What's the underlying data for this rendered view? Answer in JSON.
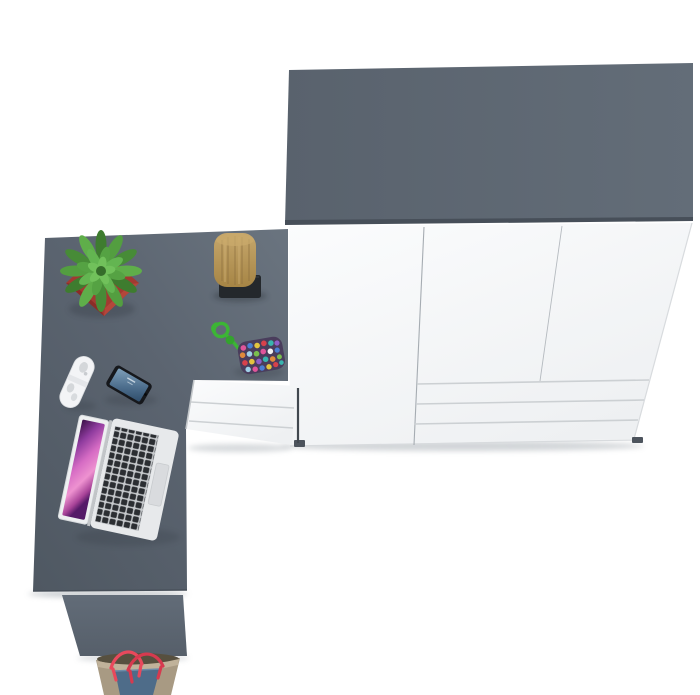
{
  "label": "Top view 3D render of a grey corner desk with white wardrobe, drawer pedestal and desk accessories",
  "colors": {
    "bg": "#ffffff",
    "slab-gray": "#5c6571",
    "slab-gray-light": "#636d78",
    "slab-edge-dark": "#474f59",
    "desk-dark": "#4f5862",
    "desk-mid": "#5b6470",
    "desk-light": "#6a747f",
    "side-panel": "#606a76",
    "side-panel-dark": "#545e69",
    "front-white": "#fafbfc",
    "front-shade": "#edeff1",
    "seam-gray": "#a6acb2",
    "drawer-line": "#ccd0d3",
    "edge-light": "#d8dbde",
    "foot-dark": "#4d545d",
    "pot-red": "#a23a31",
    "pot-red-light": "#b4463b",
    "pot-red-dark": "#8a2c27",
    "leaf-dark": "#3e7c2f",
    "leaf-mid": "#539e40",
    "leaf-light": "#5fae4a",
    "leaf-bright": "#71c15b",
    "stump-tan": "#b6945c",
    "stump-tan-light": "#c6a76c",
    "stump-tan-dark": "#a68545",
    "grain-brown": "#8c7040",
    "tray-black": "#24282c",
    "cord-green": "#3cb535",
    "pouch-base": "#4a3d5c",
    "remote-white": "#f3f4f6",
    "remote-detail": "#d4d7da",
    "phone-black": "#16181c",
    "phone-screen-1": "#7fa0ba",
    "phone-screen-2": "#2f4d6b",
    "laptop-silver": "#e7e9eb",
    "laptop-bezel": "#eef0f1",
    "key-dark": "#2b2e32",
    "key-bed": "#c7cacd",
    "trackpad": "#d9dbde",
    "wall-purple-1": "#3a1047",
    "wall-purple-2": "#8e3b9e",
    "wall-purple-3": "#d66cc4",
    "wall-purple-4": "#ee92d0",
    "wall-purple-5": "#551a68",
    "bag-beige": "#a89a83",
    "bag-rim": "#c0b29a",
    "bag-denim": "#4e6c89",
    "bag-interior": "#57503f",
    "strap-red": "#e8495c",
    "strap-red-dark": "#d63a4f",
    "shadow": "#9aa1a8"
  },
  "scene": {
    "view": "top-down product render",
    "furniture": [
      {
        "name": "wardrobe",
        "top_color": "grey",
        "front_color": "white",
        "doors": 3,
        "drawer_rows": 3,
        "feet": 2
      },
      {
        "name": "corner-desk",
        "color": "grey"
      },
      {
        "name": "drawer-pedestal",
        "color": "white",
        "drawers": 3
      },
      {
        "name": "desk-side-panel",
        "color": "grey"
      }
    ],
    "props": [
      {
        "name": "potted-plant",
        "pot_color": "red",
        "leaf_color": "green"
      },
      {
        "name": "wooden-stump",
        "on": "black-tray"
      },
      {
        "name": "bead-toy",
        "cord_color": "green",
        "beads": "multicolor"
      },
      {
        "name": "white-remote"
      },
      {
        "name": "smartphone",
        "screen": "blue wallpaper"
      },
      {
        "name": "laptop",
        "state": "open",
        "wallpaper": "purple aurora"
      },
      {
        "name": "tote-bag",
        "colors": [
          "beige",
          "denim-blue",
          "red straps"
        ]
      }
    ]
  }
}
